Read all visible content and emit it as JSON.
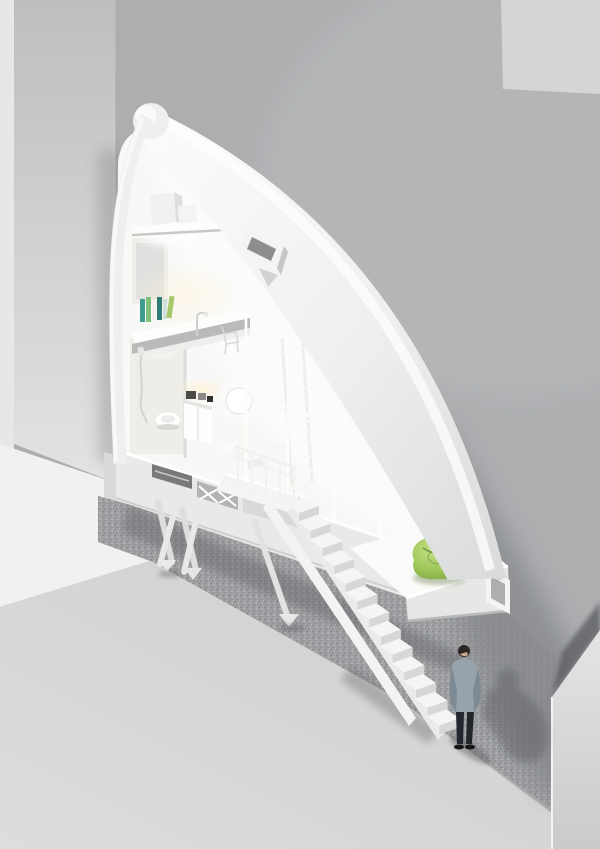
{
  "meta": {
    "title": "Narrow wedge house between two buildings - cutaway 3D architectural render",
    "canvas": {
      "width": 600,
      "height": 849
    },
    "view": "axonometric cutaway section of an ultra-narrow infill house, external stair to street, pedestrian below"
  },
  "scene": {
    "setting": "white wedge-shaped house inserted in alley between two grey buildings",
    "levels": [
      "apex storage shelf with boxes",
      "sleeping and study level with bookshelf, lamp and chair",
      "middle level with bathroom (toilet, shower hose), kitchen cabinet, paper lantern, wall ladder",
      "entry level on stilts with vents and truss",
      "lowest tip level with bean bag and end window"
    ],
    "objects": [
      "apex-cap",
      "curved-roof",
      "roof-skylight",
      "loft-shelf",
      "storage-boxes",
      "bookshelf-books",
      "desk-lamp",
      "chair",
      "bed-platform",
      "wall-ladder",
      "paper-lantern",
      "kitchen-cabinet",
      "counter-appliances",
      "toilet",
      "shower-hose",
      "interior-steps",
      "glazing-mullions",
      "guardrails",
      "base-band",
      "vent-openings",
      "truss-bay",
      "support-struts",
      "entry-platform",
      "stair-railing",
      "external-staircase",
      "tip-volume",
      "end-window",
      "bean-bag",
      "pedestrian",
      "speckled-walkway",
      "plaza",
      "boundary-fin-wall"
    ],
    "figure": {
      "type": "man",
      "pose": "standing, head bowed, at foot of external stair"
    }
  },
  "colors": {
    "wall_right": "#acaeb0",
    "wall_right_light": "#bcbec0",
    "wall_panel_topright": "#d3d5d7",
    "left_strip": "#e7e7e5",
    "left_face_top": "#bdbfbf",
    "left_face_bottom": "#e3e3e1",
    "pillar_stub": "#d9d9d7",
    "plaza_bright": "#f1f1ef",
    "plaza_main": "#cfcfcd",
    "plaza_main_light": "#dedddb",
    "terrazzo": "#9c9ea0",
    "terrazzo_dot_dark": "#838589",
    "terrazzo_dot_light": "#c9cbcd",
    "shadow_soft": "#85878a",
    "shadow_dark": "#5f6163",
    "house_shell": "#eef0ef",
    "house_shell_shade": "#d9dbdb",
    "house_highlight": "#fbfcfc",
    "interior": "#f8f8f6",
    "interior_shade": "#ededea",
    "warm_glow": "#fff3d8",
    "slab_shadow": "#c9c9c7",
    "base_band": "#e9e9e7",
    "vent_dark": "#787a78",
    "vent_panel": "#b2b4b2",
    "stairs": "#f5f5f3",
    "stair_riser": "#d7d7d5",
    "stringer": "#ebebe9",
    "fin_top": "#e3e5e5",
    "fin_bottom": "#c8cacc",
    "beanbag": "#9cc455",
    "beanbag_light": "#c4e186",
    "beanbag_dark": "#6d9440",
    "man_hair": "#2b2623",
    "man_skin": "#c9a98c",
    "man_jacket": "#97a2aa",
    "man_jacket_dark": "#7e8a93",
    "man_shirt": "#3fa8c8",
    "man_trousers": "#23262c",
    "man_shoes": "#151617",
    "books": [
      "#3f9d8f",
      "#7ec07a",
      "#f2f2f0",
      "#2e7d74",
      "#cfe0da",
      "#a5c96a"
    ]
  }
}
